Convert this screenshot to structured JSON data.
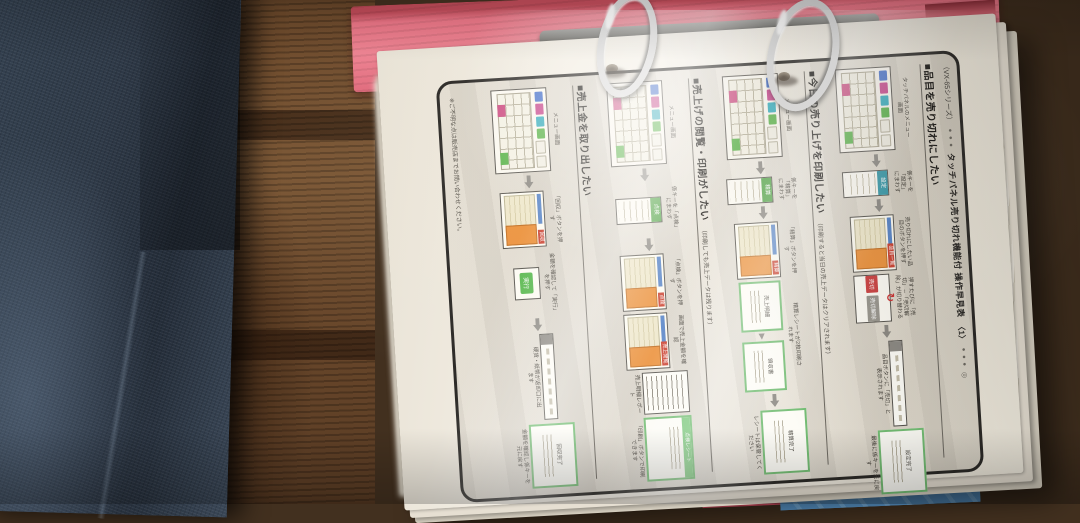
{
  "palette": {
    "binder_pink": "#ee8392",
    "denim_blue": "#2e3947",
    "wood_brown": "#5a3f29",
    "paper": "#f3eee4",
    "accent_orange": "#ec9440",
    "result_green": "#74bd74",
    "key_blue": "#4a74cc",
    "key_magenta": "#c84a8e",
    "key_teal": "#38aebe",
    "key_green": "#5cb44c"
  },
  "document": {
    "series": "（VX-65シリーズ）",
    "dots": "● ● ●",
    "title": "タッチパネル売り切れ機能付 操作早見表",
    "number": "〈1〉",
    "dots2": "● ● ●",
    "mark": "◎",
    "footer": "※ご不明な点は販売店までお問い合わせください。",
    "sections": [
      {
        "heading": "■品目を売り切れにしたい",
        "sub": "",
        "steps": [
          {
            "t": "kp",
            "n": "タッチパネルのメニュー画面"
          },
          {
            "t": "ar"
          },
          {
            "t": "tab",
            "l": "設定",
            "c": "teal",
            "n": "係キーを「設定」にまわす"
          },
          {
            "t": "ar"
          },
          {
            "t": "or",
            "l": "品目一覧",
            "n": "売り切れにしたい品目のボタンを押す"
          },
          {
            "t": "ex",
            "l": "売切",
            "l2": "売切解除",
            "n": "押すたびに「売切」⇔「売切解除」が切り替わる"
          },
          {
            "t": "ar"
          },
          {
            "t": "st",
            "nb": "品目ボタンに「売切」と表示されます"
          },
          {
            "t": "gb",
            "l": "設定完了",
            "nb": "最後に係キーを元に戻す"
          }
        ]
      },
      {
        "heading": "■今日の売り上げを印刷したい",
        "sub": "（印刷すると当日の売上データはクリアされます）",
        "steps": [
          {
            "t": "kp",
            "n": "メニュー画面"
          },
          {
            "t": "ar"
          },
          {
            "t": "tab",
            "l": "精算",
            "c": "green",
            "n": "係キーを「精算」にまわす"
          },
          {
            "t": "ar"
          },
          {
            "t": "or",
            "l": "精算",
            "n": "「精算」ボタンを押す"
          },
          {
            "t": "gb2",
            "l": "売上明細",
            "l2": "領収書",
            "n": "精算レシートが2枚印刷されます"
          },
          {
            "t": "ar"
          },
          {
            "t": "gb",
            "l": "精算完了",
            "nb": "レシートは保管してください"
          }
        ]
      },
      {
        "heading": "■売上げの閲覧・印刷がしたい",
        "sub": "（印刷しても売上データは残ります）",
        "steps": [
          {
            "t": "kp",
            "n": "メニュー画面"
          },
          {
            "t": "ar"
          },
          {
            "t": "tab",
            "l": "点検",
            "c": "green",
            "n": "係キーを「点検」にまわす"
          },
          {
            "t": "ar"
          },
          {
            "t": "or",
            "l": "点検",
            "n": "「点検」ボタンを押す"
          },
          {
            "t": "or",
            "l": "売上閲覧",
            "n": "画面で売上金額を確認"
          },
          {
            "t": "rp",
            "nb": "売上明細レポート"
          },
          {
            "t": "gb",
            "h": "点検レシート",
            "nb": "「印刷」ボタンで印刷できます"
          }
        ]
      },
      {
        "heading": "■売上金を取り出したい",
        "sub": "",
        "steps": [
          {
            "t": "kp",
            "n": "メニュー画面"
          },
          {
            "t": "ar"
          },
          {
            "t": "or",
            "l": "回収",
            "n": "「回収」ボタンを押す"
          },
          {
            "t": "btn",
            "l": "実行",
            "n": "金額を確認して「実行」を押す"
          },
          {
            "t": "ar"
          },
          {
            "t": "st",
            "nb": "硬貨・紙幣が返却口に出ます"
          },
          {
            "t": "gb",
            "l": "回収完了",
            "nb": "金額を確認し係キーを元に戻す"
          }
        ]
      }
    ]
  }
}
